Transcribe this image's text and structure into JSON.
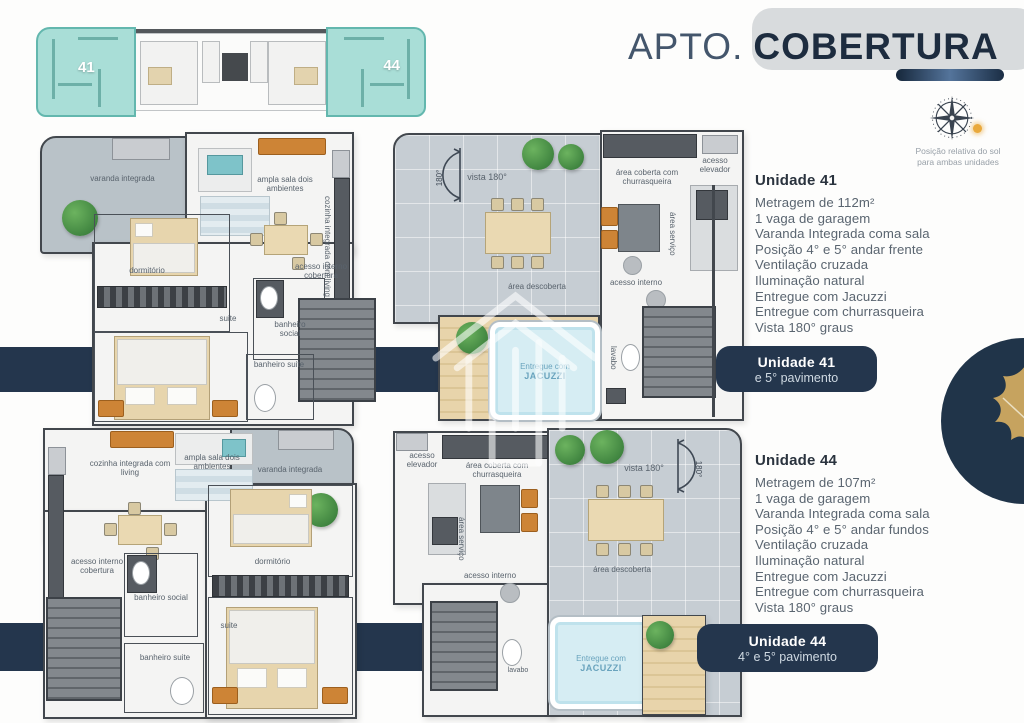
{
  "header": {
    "title_prefix": "APTO.",
    "title_highlight": "COBERTURA"
  },
  "compass": {
    "caption": "Posição relativa do sol para ambas unidades"
  },
  "keyplan": {
    "left_unit": "41",
    "right_unit": "44"
  },
  "units": [
    {
      "heading": "Unidade 41",
      "specs": [
        "Metragem de 112m²",
        "1 vaga de garagem",
        "Varanda Integrada coma sala",
        "Posição 4° e 5° andar frente",
        "Ventilação cruzada",
        "Iluminação natural",
        "Entregue com Jacuzzi",
        "Entregue com churrasqueira",
        "Vista 180° graus"
      ],
      "banner_line1": "Unidade 41",
      "banner_line2": "e 5° pavimento"
    },
    {
      "heading": "Unidade 44",
      "specs": [
        "Metragem de 107m²",
        "1 vaga de garagem",
        "Varanda Integrada coma sala",
        "Posição 4° e 5° andar fundos",
        "Ventilação cruzada",
        "Iluminação natural",
        "Entregue com Jacuzzi",
        "Entregue com churrasqueira",
        "Vista 180° graus"
      ],
      "banner_line1": "Unidade 44",
      "banner_line2": "4° e 5° pavimento"
    }
  ],
  "plan_labels": {
    "varanda": "varanda integrada",
    "sala": "ampla sala dois ambientes",
    "cozinha": "cozinha integrada com living",
    "dormitorio": "dormitório",
    "acesso_cobertura": "acesso interno cobertura",
    "banheiro_social": "banheiro social",
    "banheiro_suite": "banheiro suite",
    "suite": "suite",
    "vista": "vista 180°",
    "vista_arc": "180°",
    "area_coberta": "área coberta com churrasqueira",
    "acesso_elevador": "acesso elevador",
    "area_servico": "área serviço",
    "acesso_interno": "acesso interno",
    "area_descoberta": "área descoberta",
    "jacuzzi_line1": "Entregue com",
    "jacuzzi_line2": "JACUZZI",
    "lavabo": "lavabo"
  },
  "icons": {
    "compass": "compass-rose",
    "sun": "sun-position-dot",
    "leaf": "gold-fig-leaf",
    "watermark": "builder-house-logo",
    "arc": "view-arc-180"
  },
  "colors": {
    "navy": "#24364d",
    "title_dark": "#1d2c3f",
    "title_light": "#44566c",
    "teal_unit": "#a9ded7",
    "gold_leaf": "#c6a35f",
    "accent_orange": "#cd8436",
    "sun": "#e9a93c"
  }
}
